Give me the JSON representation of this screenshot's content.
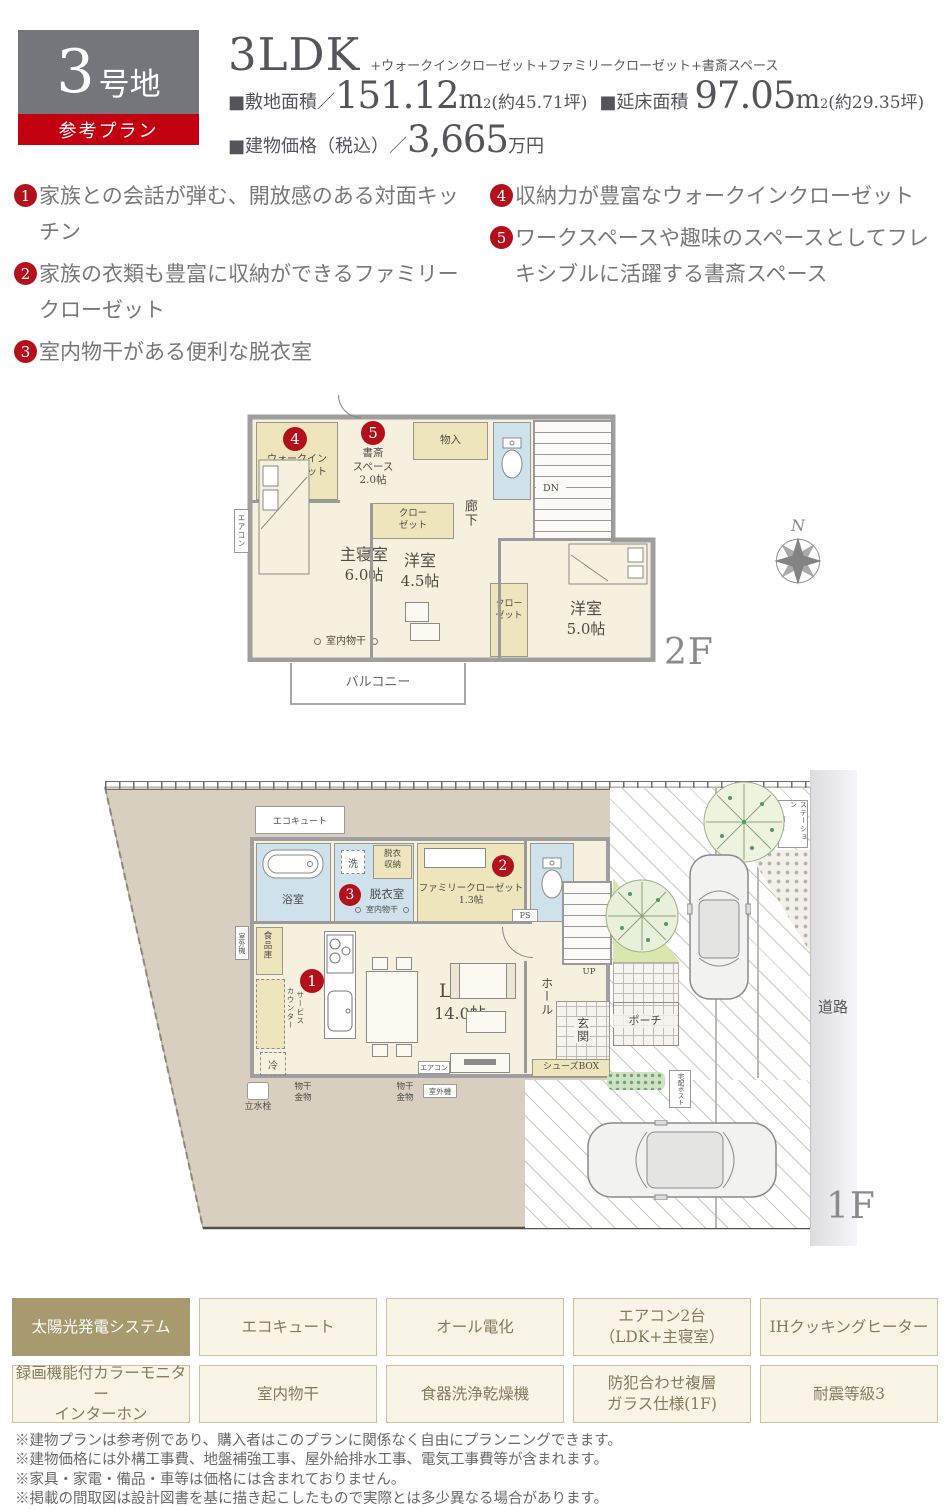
{
  "header": {
    "lot_number": "3",
    "lot_suffix": "号地",
    "ribbon": "参考プラン",
    "plan_type": "3LDK",
    "plan_suffix": "+ウォークインクローゼット+ファミリークローゼット+書斎スペース",
    "land_label": "■敷地面積／",
    "land_value": "151.12",
    "unit_m": "m",
    "unit_sup": "2",
    "land_tsubo": "(約45.71坪)",
    "floor_label": "■延床面積",
    "floor_value": "97.05",
    "floor_tsubo": "(約29.35坪)",
    "price_label": "■建物価格（税込）／",
    "price_value": "3,665",
    "price_unit": "万円"
  },
  "features": [
    {
      "num": "1",
      "text": "家族との会話が弾む、開放感のある対面キッチン"
    },
    {
      "num": "2",
      "text": "家族の衣類も豊富に収納ができるファミリークローゼット"
    },
    {
      "num": "3",
      "text": "室内物干がある便利な脱衣室"
    },
    {
      "num": "4",
      "text": "収納力が豊富なウォークインクローゼット"
    },
    {
      "num": "5",
      "text": "ワークスペースや趣味のスペースとしてフレキシブルに活躍する書斎スペース"
    }
  ],
  "plan2f": {
    "floor_label": "2F",
    "compass_n": "N",
    "wic": {
      "num": "4",
      "l1": "ウォークイン",
      "l2": "クローゼット",
      "l3": "2.0帖"
    },
    "study": {
      "num": "5",
      "l1": "書斎",
      "l2": "スペース",
      "l3": "2.0帖"
    },
    "storage": "物入",
    "dn": "DN",
    "corridor": "廊下",
    "closet_mid": {
      "l1": "クロー",
      "l2": "ゼット"
    },
    "closet_right": {
      "l1": "クロー",
      "l2": "ゼット"
    },
    "master": {
      "l1": "主寝室",
      "l2": "6.0帖"
    },
    "western45": {
      "l1": "洋室",
      "l2": "4.5帖"
    },
    "western50": {
      "l1": "洋室",
      "l2": "5.0帖"
    },
    "drying": "室内物干",
    "balcony": "バルコニー",
    "aircon": "エアコン"
  },
  "plan1f": {
    "floor_label": "1F",
    "ecocute": "エコキュート",
    "bath": "浴室",
    "wash": "洗",
    "undress_storage": {
      "l1": "脱衣",
      "l2": "収納"
    },
    "undress_room": {
      "num": "3",
      "label": "脱衣室",
      "drying": "室内物干"
    },
    "family_closet": {
      "num": "2",
      "l1": "ファミリークローゼット",
      "l2": "1.3帖"
    },
    "ps": "PS",
    "pantry": "食品庫",
    "service_counter": {
      "l1": "サービス",
      "l2": "カウンター"
    },
    "kitchen_num": "1",
    "ldk": {
      "l1": "LDK",
      "l2": "14.0帖"
    },
    "fridge": "冷",
    "aircon": "エアコン",
    "hall": "ホール",
    "up": "UP",
    "entrance": "玄関",
    "shoes_box": "シューズBOX",
    "porch": "ポーチ",
    "delivery_post": "宅配ポスト",
    "garbage": {
      "l1": "ゴミ",
      "l2": "ステーション"
    },
    "road": "道路",
    "tap": "立水栓",
    "hang1": {
      "l1": "物干",
      "l2": "金物"
    },
    "hang2": {
      "l1": "物干",
      "l2": "金物"
    },
    "outdoor_unit_left": "室外機",
    "outdoor_unit_bottom": "室外機"
  },
  "badges": [
    {
      "l1": "太陽光発電システム",
      "l2": ""
    },
    {
      "l1": "エコキュート",
      "l2": ""
    },
    {
      "l1": "オール電化",
      "l2": ""
    },
    {
      "l1": "エアコン2台",
      "l2": "（LDK+主寝室）"
    },
    {
      "l1": "IHクッキングヒーター",
      "l2": ""
    },
    {
      "l1": "録画機能付カラーモニター",
      "l2": "インターホン"
    },
    {
      "l1": "室内物干",
      "l2": ""
    },
    {
      "l1": "食器洗浄乾燥機",
      "l2": ""
    },
    {
      "l1": "防犯合わせ複層",
      "l2": "ガラス仕様(1F)"
    },
    {
      "l1": "耐震等級3",
      "l2": ""
    }
  ],
  "notes": [
    "※建物プランは参考例であり、購入者はこのプランに関係なく自由にプランニングできます。",
    "※建物価格には外構工事費、地盤補強工事、屋外給排水工事、電気工事費等が含まれます。",
    "※家具・家電・備品・車等は価格には含まれておりません。",
    "※掲載の間取図は設計図書を基に描き起こしたもので実際とは多少異なる場合があります。"
  ]
}
